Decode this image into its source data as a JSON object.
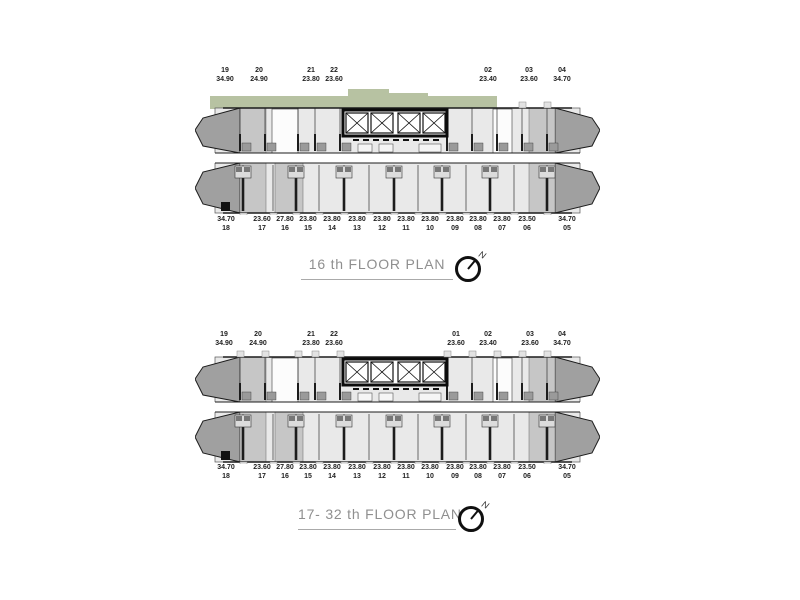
{
  "page": {
    "background": "#ffffff"
  },
  "colors": {
    "green_roof": "#b7c2a2",
    "unit_light": "#e9e9e9",
    "unit_mid": "#c6c6c6",
    "unit_dark": "#a0a0a0",
    "wall": "#1c1c1c",
    "title_text": "#8f8f8f",
    "label_text": "#222222"
  },
  "plans": [
    {
      "id": "floor-16",
      "title": "16 th FLOOR PLAN",
      "compass_label": "N",
      "green_roof": true,
      "top_units": [
        {
          "unit": "19",
          "area": "34.90",
          "x": 225
        },
        {
          "unit": "20",
          "area": "24.90",
          "x": 259
        },
        {
          "unit": "21",
          "area": "23.80",
          "x": 311
        },
        {
          "unit": "22",
          "area": "23.60",
          "x": 334
        },
        {
          "unit": "02",
          "area": "23.40",
          "x": 488
        },
        {
          "unit": "03",
          "area": "23.60",
          "x": 529
        },
        {
          "unit": "04",
          "area": "34.70",
          "x": 562
        }
      ],
      "bottom_units": [
        {
          "area": "34.70",
          "unit": "18",
          "x": 226
        },
        {
          "area": "23.60",
          "unit": "17",
          "x": 262
        },
        {
          "area": "27.80",
          "unit": "16",
          "x": 285
        },
        {
          "area": "23.80",
          "unit": "15",
          "x": 308
        },
        {
          "area": "23.80",
          "unit": "14",
          "x": 332
        },
        {
          "area": "23.80",
          "unit": "13",
          "x": 357
        },
        {
          "area": "23.80",
          "unit": "12",
          "x": 382
        },
        {
          "area": "23.80",
          "unit": "11",
          "x": 406
        },
        {
          "area": "23.80",
          "unit": "10",
          "x": 430
        },
        {
          "area": "23.80",
          "unit": "09",
          "x": 455
        },
        {
          "area": "23.80",
          "unit": "08",
          "x": 478
        },
        {
          "area": "23.80",
          "unit": "07",
          "x": 502
        },
        {
          "area": "23.50",
          "unit": "06",
          "x": 527
        },
        {
          "area": "34.70",
          "unit": "05",
          "x": 567
        }
      ]
    },
    {
      "id": "floor-17-32",
      "title": "17- 32 th FLOOR PLAN",
      "compass_label": "N",
      "green_roof": false,
      "top_units": [
        {
          "unit": "19",
          "area": "34.90",
          "x": 224
        },
        {
          "unit": "20",
          "area": "24.90",
          "x": 258
        },
        {
          "unit": "21",
          "area": "23.80",
          "x": 311
        },
        {
          "unit": "22",
          "area": "23.60",
          "x": 334
        },
        {
          "unit": "01",
          "area": "23.60",
          "x": 456
        },
        {
          "unit": "02",
          "area": "23.40",
          "x": 488
        },
        {
          "unit": "03",
          "area": "23.60",
          "x": 530
        },
        {
          "unit": "04",
          "area": "34.70",
          "x": 562
        }
      ],
      "bottom_units": [
        {
          "area": "34.70",
          "unit": "18",
          "x": 226
        },
        {
          "area": "23.60",
          "unit": "17",
          "x": 262
        },
        {
          "area": "27.80",
          "unit": "16",
          "x": 285
        },
        {
          "area": "23.80",
          "unit": "15",
          "x": 308
        },
        {
          "area": "23.80",
          "unit": "14",
          "x": 332
        },
        {
          "area": "23.80",
          "unit": "13",
          "x": 357
        },
        {
          "area": "23.80",
          "unit": "12",
          "x": 382
        },
        {
          "area": "23.80",
          "unit": "11",
          "x": 406
        },
        {
          "area": "23.80",
          "unit": "10",
          "x": 430
        },
        {
          "area": "23.80",
          "unit": "09",
          "x": 455
        },
        {
          "area": "23.80",
          "unit": "08",
          "x": 478
        },
        {
          "area": "23.80",
          "unit": "07",
          "x": 502
        },
        {
          "area": "23.50",
          "unit": "06",
          "x": 527
        },
        {
          "area": "34.70",
          "unit": "05",
          "x": 567
        }
      ]
    }
  ]
}
